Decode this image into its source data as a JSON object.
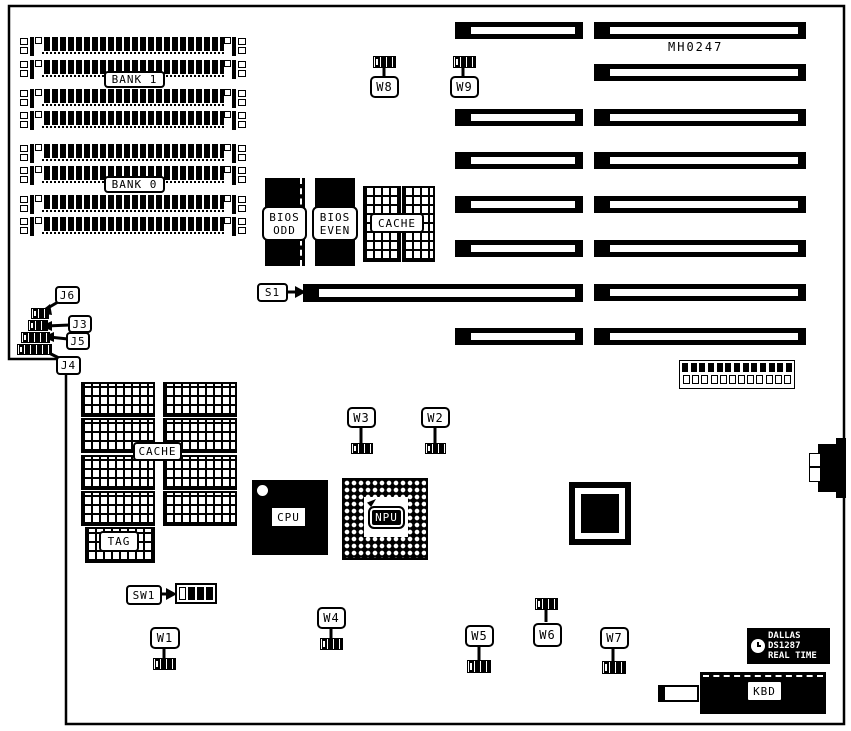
{
  "diagram": {
    "part_number": "MH0247",
    "colors": {
      "ink": "#000000",
      "paper": "#ffffff"
    },
    "memory": {
      "bank1": "BANK 1",
      "bank0": "BANK 0"
    },
    "bios": {
      "odd": [
        "BIOS",
        "ODD"
      ],
      "even": [
        "BIOS",
        "EVEN"
      ]
    },
    "cache": {
      "top": "CACHE",
      "bottom": "CACHE",
      "tag": "TAG"
    },
    "processors": {
      "cpu": "CPU",
      "npu": "NPU"
    },
    "slot": {
      "s1": "S1"
    },
    "switch": {
      "sw1": "SW1"
    },
    "jumpers": {
      "w1": "W1",
      "w2": "W2",
      "w3": "W3",
      "w4": "W4",
      "w5": "W5",
      "w6": "W6",
      "w7": "W7",
      "w8": "W8",
      "w9": "W9",
      "j3": "J3",
      "j4": "J4",
      "j5": "J5",
      "j6": "J6"
    },
    "rtc": {
      "brand": "DALLAS",
      "part": "DS1287",
      "type": "REAL TIME"
    },
    "keyboard": {
      "label": "KBD"
    }
  }
}
